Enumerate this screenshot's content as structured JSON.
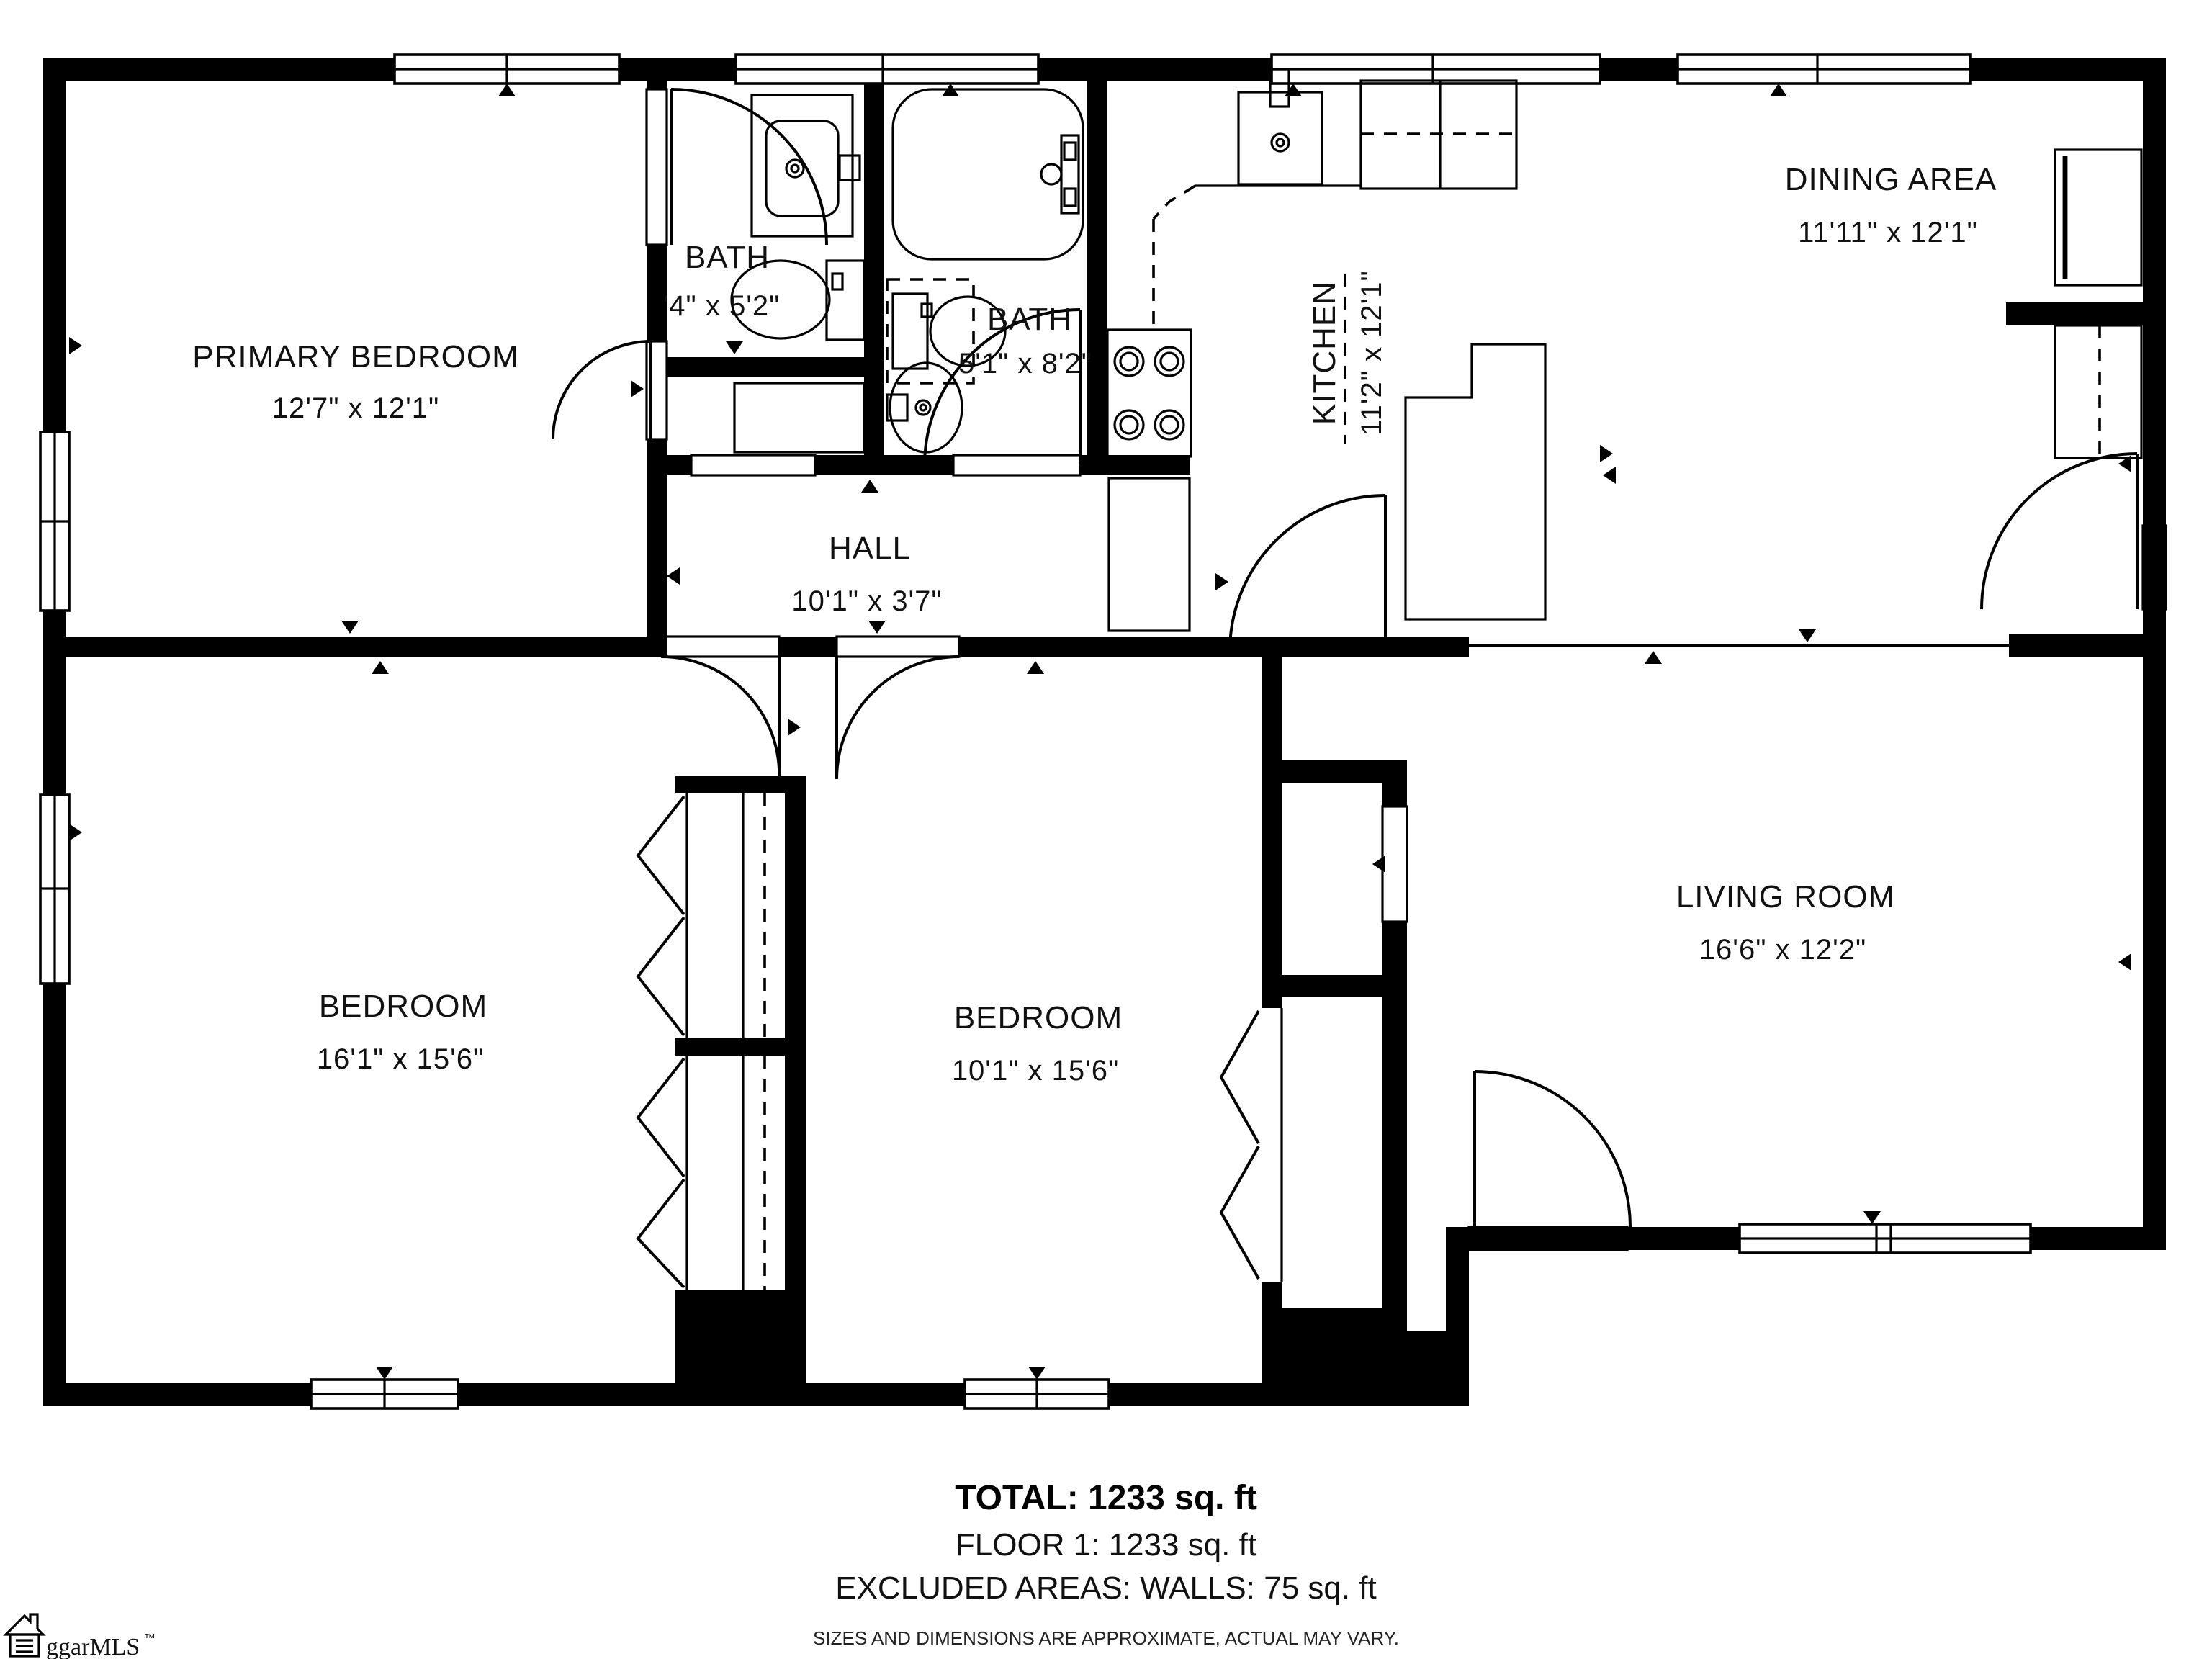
{
  "floorplan": {
    "rooms": {
      "primary_bedroom": {
        "name": "PRIMARY BEDROOM",
        "dims": "12'7\" x 12'1\""
      },
      "bath1": {
        "name": "BATH",
        "dims": "'4\" x 5'2\""
      },
      "bath2": {
        "name": "BATH",
        "dims": "5'1\" x 8'2\""
      },
      "kitchen": {
        "name": "KITCHEN",
        "dims": "11'2\" x 12'1\""
      },
      "dining": {
        "name": "DINING AREA",
        "dims": "11'11\" x 12'1\""
      },
      "hall": {
        "name": "HALL",
        "dims": "10'1\" x 3'7\""
      },
      "bedroom_left": {
        "name": "BEDROOM",
        "dims": "16'1\" x 15'6\""
      },
      "bedroom_middle": {
        "name": "BEDROOM",
        "dims": "10'1\" x 15'6\""
      },
      "living_room": {
        "name": "LIVING ROOM",
        "dims": "16'6\" x 12'2\""
      }
    },
    "summary": {
      "total": "TOTAL: 1233 sq. ft",
      "floor": "FLOOR 1: 1233 sq. ft",
      "excluded": "EXCLUDED AREAS: WALLS: 75 sq. ft",
      "disclaimer": "SIZES AND DIMENSIONS ARE APPROXIMATE, ACTUAL MAY VARY."
    },
    "branding": {
      "logo_text": "ggarMLS",
      "trademark": "™"
    },
    "colors": {
      "ink": "#000000",
      "background": "#ffffff"
    }
  }
}
